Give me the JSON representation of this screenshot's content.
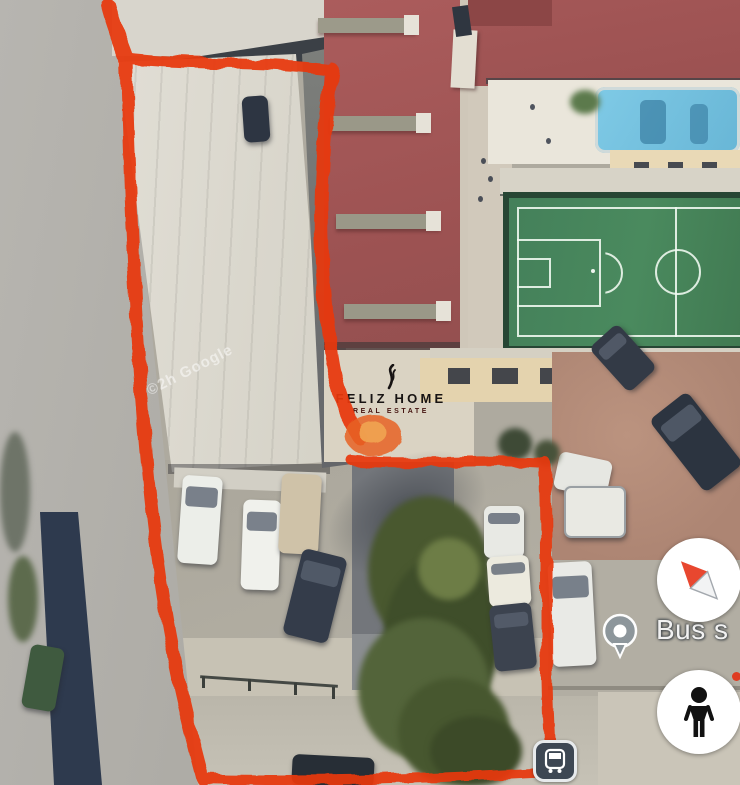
{
  "title": "Satellite map with property boundary annotation",
  "watermark": "©2h Google",
  "logo": {
    "icon": "flame-icon",
    "name": "FELIZ HOME",
    "tagline": "REAL ESTATE"
  },
  "map_labels": {
    "bus_stop": "Bus s"
  },
  "controls": {
    "compass": {
      "icon": "compass-icon"
    },
    "pegman": {
      "icon": "pegman-icon"
    },
    "bus_stop_pin": {
      "icon": "bus-stop-pin-icon"
    },
    "transit_station": {
      "icon": "bus-transit-icon"
    }
  },
  "colors": {
    "annotation": "#e8380e",
    "roof_red": "#a85a5a",
    "pitch_green": "#47815a",
    "pool_blue": "#76c4e0",
    "label_text": "#f2f2f2"
  }
}
